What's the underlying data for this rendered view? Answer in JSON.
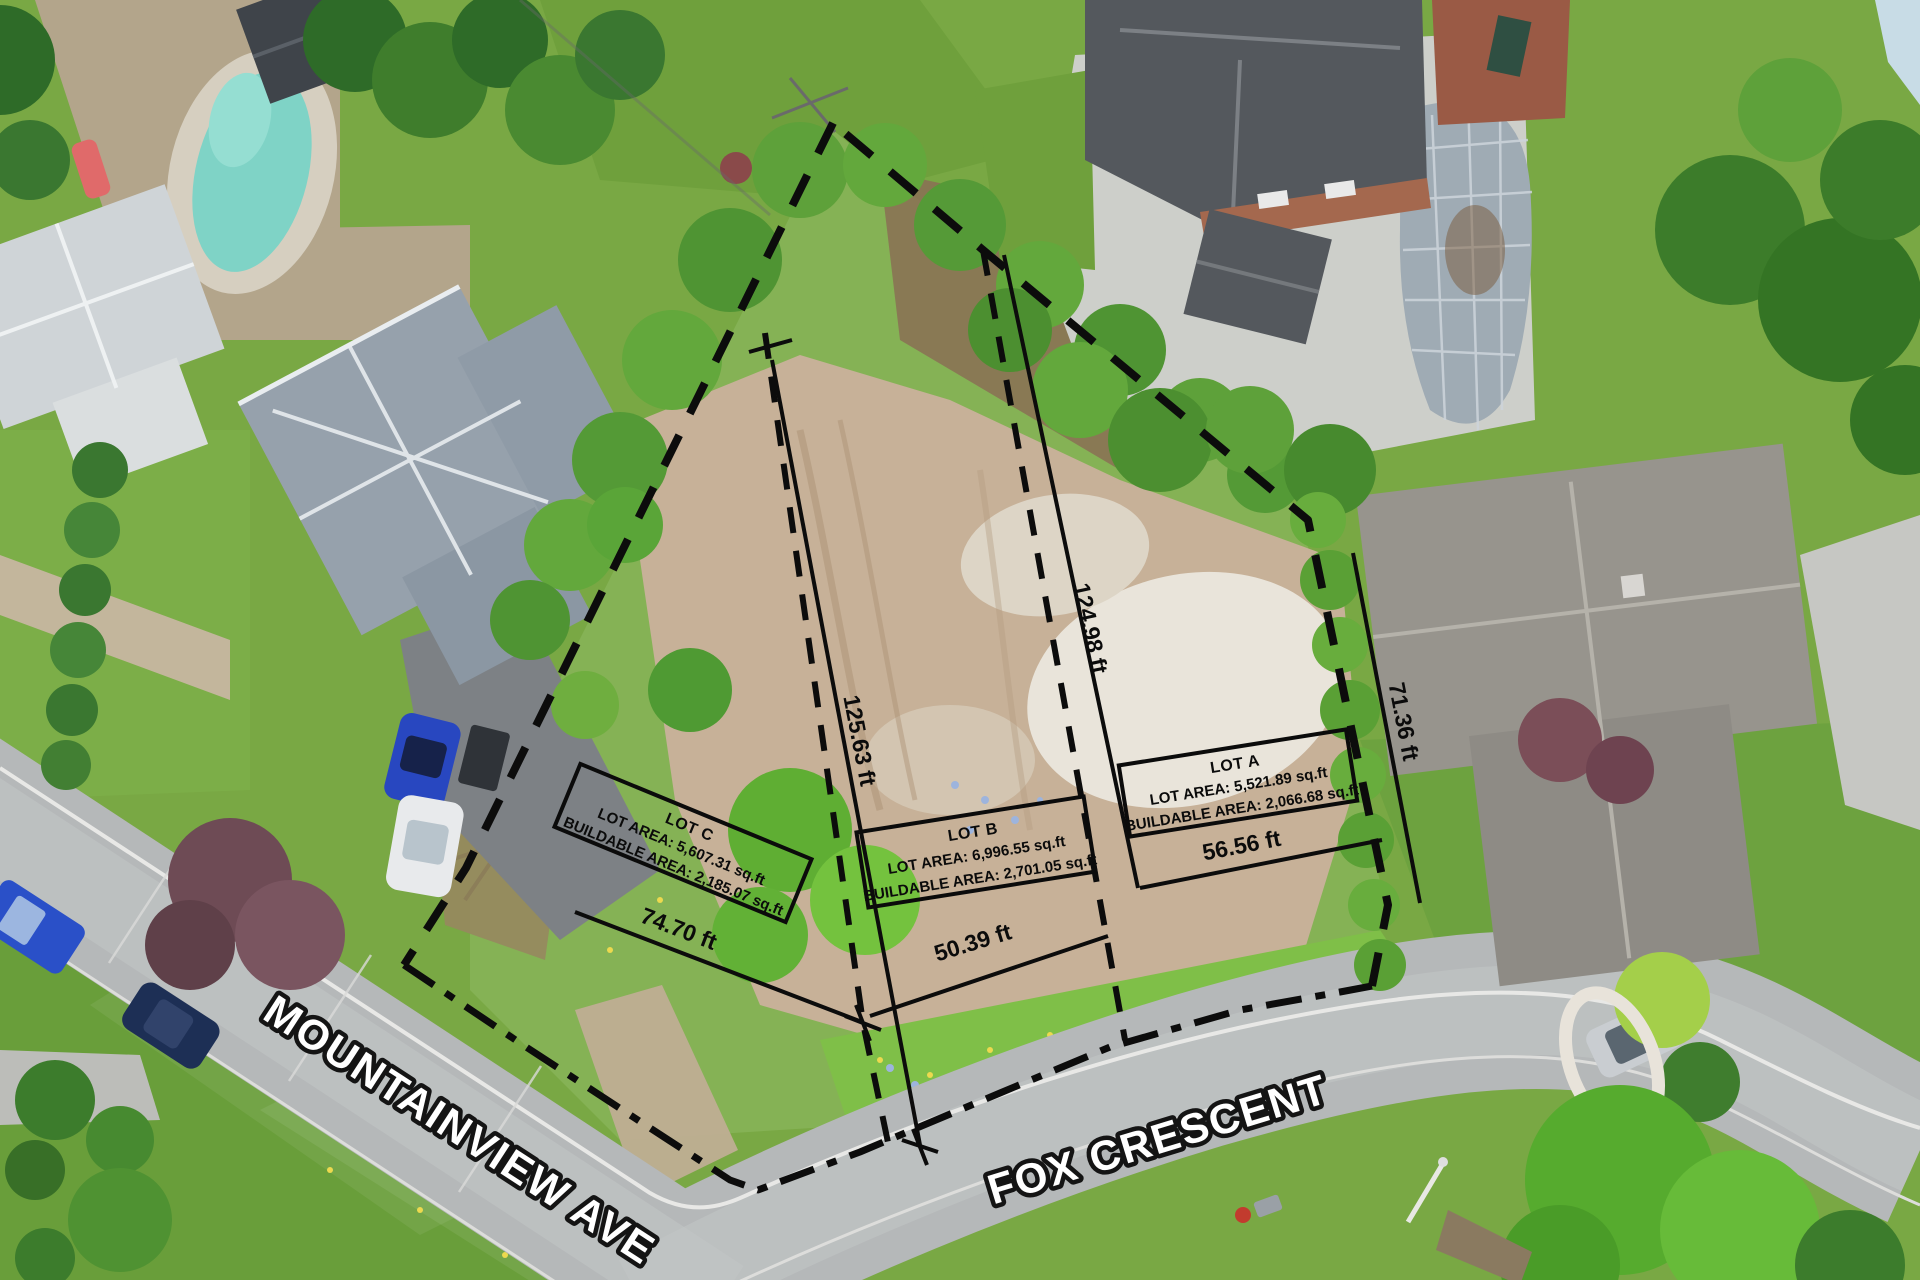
{
  "image": {
    "kind": "aerial-drone-photo-with-survey-overlay",
    "description": "Aerial view of a vacant treed/cleared parcel at the corner of Mountainview Ave and Fox Crescent, divided into three proposed lots"
  },
  "streets": {
    "mountainview": "MOUNTAINVIEW AVE",
    "fox": "FOX CRESCENT"
  },
  "lots": {
    "a": {
      "title": "LOT A",
      "area": "LOT AREA: 5,521.89 sq.ft",
      "buildable": "BUILDABLE AREA: 2,066.68 sq.ft"
    },
    "b": {
      "title": "LOT B",
      "area": "LOT AREA: 6,996.55 sq.ft",
      "buildable": "BUILDABLE AREA: 2,701.05 sq.ft"
    },
    "c": {
      "title": "LOT C",
      "area": "LOT AREA: 5,607.31 sq.ft",
      "buildable": "BUILDABLE AREA: 2,185.07 sq.ft"
    }
  },
  "measurements": {
    "divider_c_b": "125.63 ft",
    "divider_b_a": "124.98 ft",
    "lot_a_east_side": "71.36 ft",
    "lot_c_frontage": "74.70 ft",
    "lot_b_frontage": "50.39 ft",
    "lot_a_frontage": "56.56 ft"
  },
  "colors": {
    "survey_line": "#0c0c0c",
    "street_label_fill": "#ffffff",
    "street_label_outline": "#141414",
    "grass": "#79a844",
    "cleared_dirt": "#c9b299",
    "road_asphalt": "#b5b8b9",
    "pool_water": "#7fd3c6",
    "roof_gray": "#96a1ac"
  }
}
